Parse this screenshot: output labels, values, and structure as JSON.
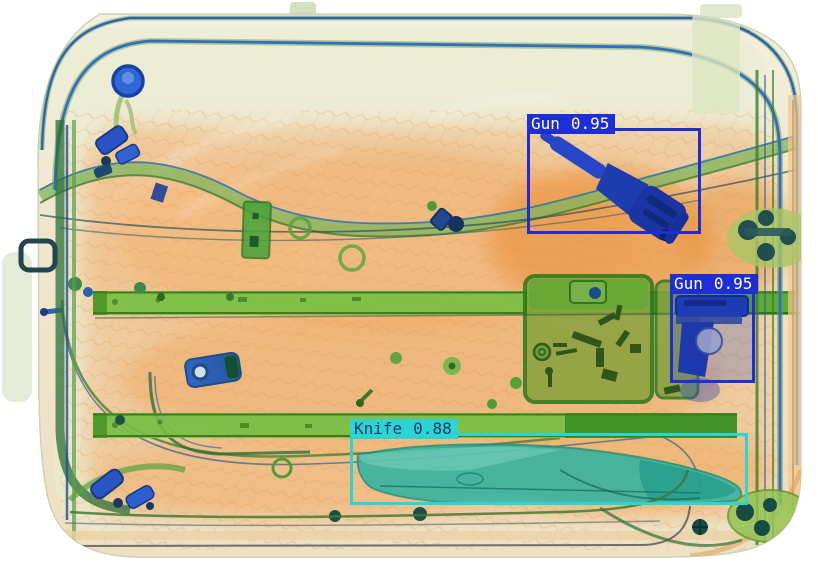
{
  "scene": {
    "description": "X-ray security scan of a suitcase containing detected threat objects",
    "background_color": "#ffffff"
  },
  "palette": {
    "gun_box_color": "#1d2ed6",
    "knife_box_color": "#2bd5d5",
    "gun_label_text": "#ffffff",
    "knife_label_text": "#17386e",
    "xray_orange": "#f0a45c",
    "xray_green": "#74bf42",
    "xray_blue": "#1e3cb5",
    "xray_teal": "#25b3a3"
  },
  "detections": [
    {
      "id": "gun-1",
      "label": "Gun",
      "score": "0.95",
      "color": "#1d2ed6",
      "text_color": "#ffffff",
      "box": {
        "x": 527,
        "y": 128,
        "w": 174,
        "h": 106
      }
    },
    {
      "id": "gun-2",
      "label": "Gun",
      "score": "0.95",
      "color": "#1d2ed6",
      "text_color": "#ffffff",
      "box": {
        "x": 670,
        "y": 288,
        "w": 85,
        "h": 95
      }
    },
    {
      "id": "knife-1",
      "label": "Knife",
      "score": "0.88",
      "color": "#2bd5d5",
      "text_color": "#17386e",
      "box": {
        "x": 350,
        "y": 433,
        "w": 398,
        "h": 72
      }
    }
  ]
}
